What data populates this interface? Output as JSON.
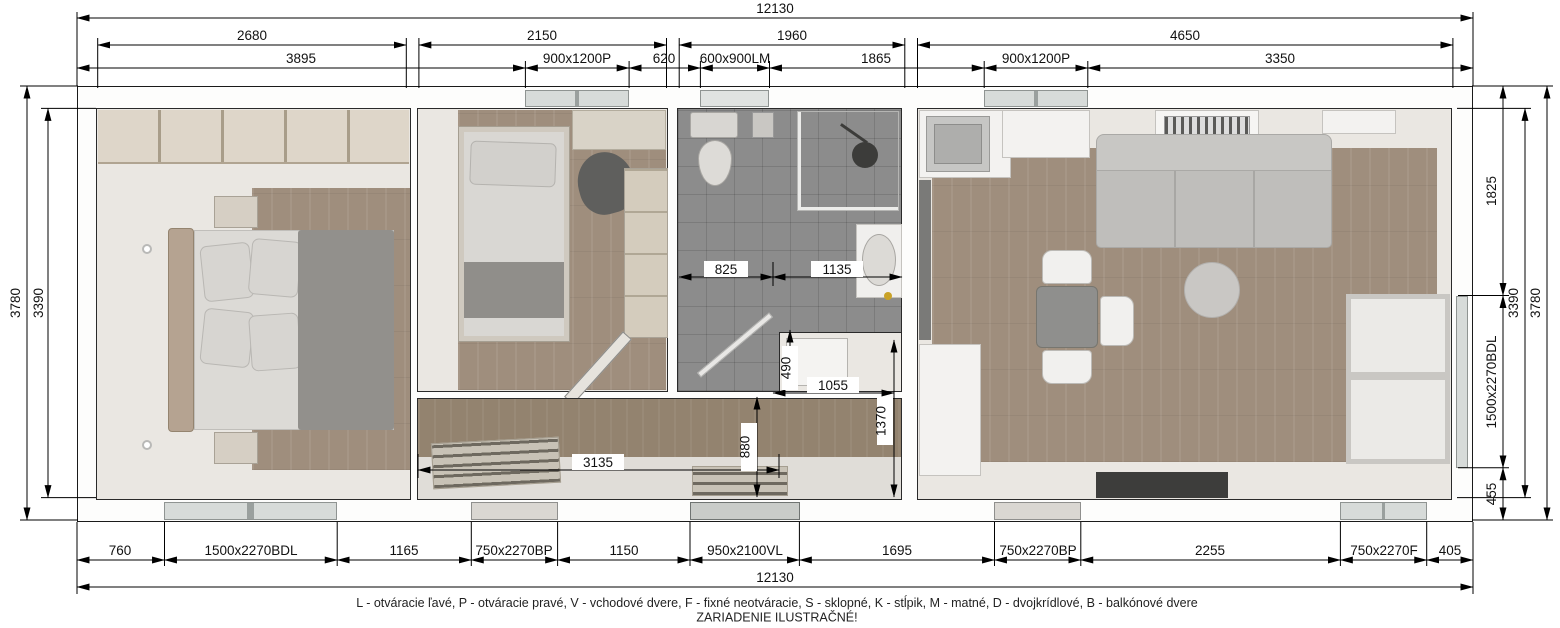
{
  "dimensions": {
    "overall_top": "12130",
    "overall_bottom": "12130",
    "room_widths": [
      "2680",
      "2150",
      "1960",
      "4650"
    ],
    "top_segments": [
      "3895",
      "900x1200P",
      "620",
      "600x900LM",
      "1865",
      "900x1200P",
      "3350"
    ],
    "bottom_segments": [
      "760",
      "1500x2270BDL",
      "1165",
      "750x2270BP",
      "1150",
      "950x2100VL",
      "1695",
      "750x2270BP",
      "2255",
      "750x2270F",
      "405"
    ],
    "left": {
      "overall": "3780",
      "interior": "3390"
    },
    "right": {
      "top": "1825",
      "window": "1500x2270BDL",
      "bottom": "455",
      "interior": "3390",
      "overall": "3780"
    },
    "interior": {
      "bath_left": "825",
      "bath_right": "1135",
      "step": "490",
      "nook_width": "1055",
      "nook_height": "1370",
      "hall_height": "880",
      "hall_width": "3135"
    }
  },
  "legend": {
    "line1": "L - otváracie ľavé, P - otváracie pravé, V - vchodové dvere, F - fixné neotváracie, S - sklopné, K - stĺpik, M - matné, D - dvojkrídlové, B - balkónové dvere",
    "line2": "ZARIADENIE ILUSTRAČNÉ!"
  },
  "colors": {
    "wood_floor": "#9f8e7d",
    "bath_tile": "#8c8c8c",
    "cream_floor": "#eae7e2",
    "drawing_line": "#111111"
  }
}
